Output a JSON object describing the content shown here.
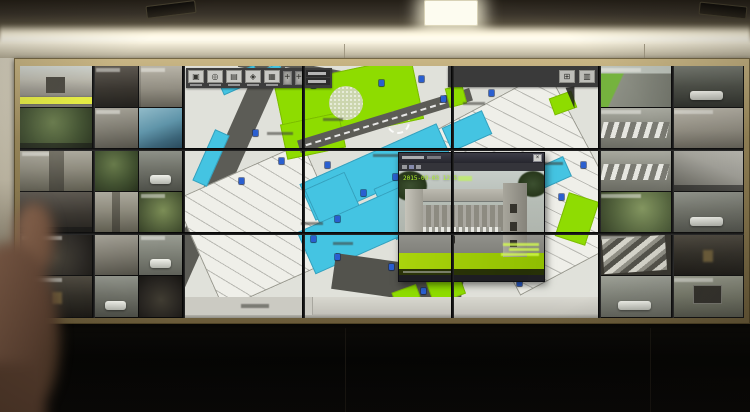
{
  "colors": {
    "map_green": "#8edc00",
    "map_cyan": "#44c4e2",
    "road": "#5c5c56",
    "highlight": "#e3ea3c",
    "timestamp": "#b4f82e",
    "frame_gold": "#9c8a5c"
  },
  "wall": {
    "left_tiles": [
      {
        "scene": "entrance",
        "hl": true
      },
      {
        "scene": "alleydark",
        "cap": "t"
      },
      {
        "scene": "facade",
        "cap": "t"
      },
      {
        "scene": "foliage",
        "cap": "b"
      },
      {
        "scene": "graybuilding",
        "cap": "t"
      },
      {
        "scene": "bluetarp"
      },
      {
        "scene": "lane",
        "cap": "t"
      },
      {
        "scene": "foliage"
      },
      {
        "scene": "whitecar",
        "car": true
      },
      {
        "scene": "alleydark",
        "cap": "b"
      },
      {
        "scene": "lane"
      },
      {
        "scene": "courtyard",
        "cap": "t"
      },
      {
        "scene": "garage",
        "cap": "t"
      },
      {
        "scene": "graybuilding"
      },
      {
        "scene": "streetcar",
        "car": true,
        "cap": "t"
      },
      {
        "scene": "nightdoor",
        "cap": "t"
      },
      {
        "scene": "whitecar",
        "car": true
      },
      {
        "scene": "garage"
      }
    ],
    "right_tiles": [
      {
        "scene": "streetlawn",
        "cap": "t"
      },
      {
        "scene": "darkstreet",
        "car": true
      },
      {
        "scene": "parking",
        "cap": "t"
      },
      {
        "scene": "facade",
        "cap": "t"
      },
      {
        "scene": "parking"
      },
      {
        "scene": "roofbig",
        "cap": "b"
      },
      {
        "scene": "yard",
        "cap": "t"
      },
      {
        "scene": "whitecar",
        "car": true
      },
      {
        "scene": "stairs",
        "cap": "t"
      },
      {
        "scene": "nightdoor"
      },
      {
        "scene": "streetcar",
        "car": true
      },
      {
        "scene": "grille",
        "cap": "t"
      }
    ]
  },
  "map": {
    "toolbar_buttons": [
      {
        "glyph": "▣"
      },
      {
        "glyph": "◎"
      },
      {
        "glyph": "▤"
      },
      {
        "glyph": "◈"
      },
      {
        "glyph": "▦"
      }
    ],
    "panel_buttons": [
      {
        "glyph": "⊞"
      },
      {
        "glyph": "▥"
      }
    ],
    "dpad_glyph": "+",
    "markers": [
      {
        "x": 62,
        "y": 10
      },
      {
        "x": 98,
        "y": 6
      },
      {
        "x": 128,
        "y": 16
      },
      {
        "x": 196,
        "y": 14
      },
      {
        "x": 236,
        "y": 10
      },
      {
        "x": 258,
        "y": 30
      },
      {
        "x": 306,
        "y": 24
      },
      {
        "x": 70,
        "y": 64
      },
      {
        "x": 56,
        "y": 112
      },
      {
        "x": 96,
        "y": 92
      },
      {
        "x": 142,
        "y": 96
      },
      {
        "x": 178,
        "y": 124
      },
      {
        "x": 210,
        "y": 108
      },
      {
        "x": 152,
        "y": 150
      },
      {
        "x": 128,
        "y": 170
      },
      {
        "x": 152,
        "y": 188
      },
      {
        "x": 206,
        "y": 198
      },
      {
        "x": 238,
        "y": 222
      },
      {
        "x": 334,
        "y": 214
      },
      {
        "x": 376,
        "y": 128
      },
      {
        "x": 398,
        "y": 96
      },
      {
        "x": 286,
        "y": 120
      }
    ],
    "labels": [
      {
        "x": 84,
        "y": 66,
        "w": 26
      },
      {
        "x": 140,
        "y": 52,
        "w": 20
      },
      {
        "x": 190,
        "y": 88,
        "w": 30
      },
      {
        "x": 252,
        "y": 118,
        "w": 26
      },
      {
        "x": 118,
        "y": 156,
        "w": 22
      },
      {
        "x": 226,
        "y": 196,
        "w": 28
      },
      {
        "x": 150,
        "y": 176,
        "w": 20
      },
      {
        "x": 280,
        "y": 36,
        "w": 22
      },
      {
        "x": 356,
        "y": 96,
        "w": 24
      },
      {
        "x": 310,
        "y": 156,
        "w": 26
      },
      {
        "x": 199,
        "y": 238,
        "w": 18
      }
    ]
  },
  "popup": {
    "timestamp_visible": "2015-09-03 12:5",
    "close_glyph": "×",
    "camera_text_lines": 3
  }
}
